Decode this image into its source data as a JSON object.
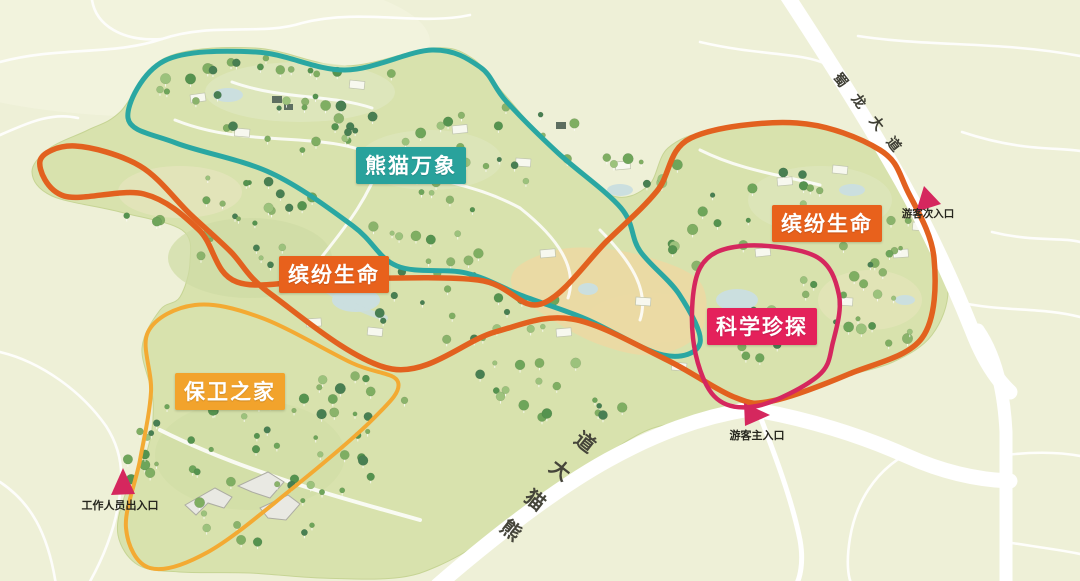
{
  "map": {
    "name": "panda-park-guide-map",
    "zones": [
      {
        "id": "panda-universe",
        "label": "熊猫万象",
        "color": "#29a29c"
      },
      {
        "id": "colorful-life-west",
        "label": "缤纷生命",
        "color": "#e8611c"
      },
      {
        "id": "colorful-life-east",
        "label": "缤纷生命",
        "color": "#e8611c"
      },
      {
        "id": "science-exploration",
        "label": "科学珍探",
        "color": "#e4215b"
      },
      {
        "id": "guardian-home",
        "label": "保卫之家",
        "color": "#f2a32c"
      }
    ],
    "routes": [
      {
        "id": "panda-universe-route",
        "color": "#2aa7a2"
      },
      {
        "id": "colorful-life-route",
        "color": "#e2611f"
      },
      {
        "id": "science-exploration-route",
        "color": "#d5275e"
      },
      {
        "id": "guardian-home-route",
        "color": "#f3aa33"
      }
    ],
    "roads": [
      {
        "id": "shulong-avenue",
        "label": "蜀龙大道",
        "chars": [
          "蜀",
          "龙",
          "大",
          "道"
        ]
      },
      {
        "id": "xiongmao-avenue",
        "label": "熊猫大道",
        "chars": [
          "熊",
          "猫",
          "大",
          "道"
        ]
      }
    ],
    "entrances": [
      {
        "id": "visitor-secondary-entrance",
        "label": "游客次入口"
      },
      {
        "id": "visitor-main-entrance",
        "label": "游客主入口"
      },
      {
        "id": "staff-entrance",
        "label": "工作人员出入口"
      }
    ],
    "entrance_marker_color": "#d5275e",
    "colors": {
      "background": "#eef0d7",
      "park_green": "#d8e2ad",
      "sand_area": "#ecd9a3",
      "water": "#cbdfdf",
      "road_white": "#ffffff"
    }
  }
}
